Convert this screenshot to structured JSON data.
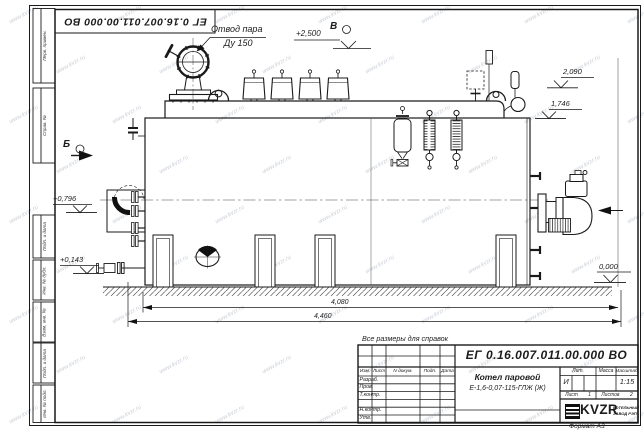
{
  "watermark": {
    "text": "www.kvzr.ru"
  },
  "frame": {
    "sidebar_fields": [
      "Перв. примен.",
      "Справ. №",
      "Подп. и дата",
      "Инв. № дубл.",
      "Взам. инв. №",
      "Подп. и дата",
      "Инв. № подл."
    ],
    "format_note": "Формат А3"
  },
  "annotations": {
    "steam_outlet_line1": "Отвод пара",
    "steam_outlet_line2": "Ду 150",
    "view_letter_top": "В",
    "view_letter_left": "Б",
    "elev_valve_top": "+2,500",
    "elev_right_upper": "2,090",
    "elev_right_lower": "1,746",
    "elev_left_upper": "+0,796",
    "elev_left_lower": "+0,143",
    "elev_ground": "0,000",
    "dim_inner": "4,080",
    "dim_overall": "4,460",
    "reference_note": "Все размеры для справок"
  },
  "title_block": {
    "designation": "ЕГ 0.16.007.011.00.000  ВО",
    "product_name": "Котел паровой",
    "product_type": "Е-1,6-0,07-115-ГЛЖ (Ж)",
    "header_cols": [
      "Изм.",
      "Лист",
      "N докум.",
      "Подп.",
      "Дата"
    ],
    "signature_rows": [
      "Разраб.",
      "Пров.",
      "Т.контр.",
      "Н.контр.",
      "Утв."
    ],
    "lit_label": "Лит.",
    "lit_value": "И",
    "mass_label": "Масса",
    "scale_label": "Масштаб",
    "scale_value": "1:15",
    "sheet_label": "Лист",
    "sheet_value": "1",
    "sheets_label": "Листов",
    "sheets_value": "2",
    "logo_text": "KVZR",
    "company_line1": "КОТЕЛЬНЫЙ",
    "company_line2": "ЗАВОД РЭП"
  }
}
